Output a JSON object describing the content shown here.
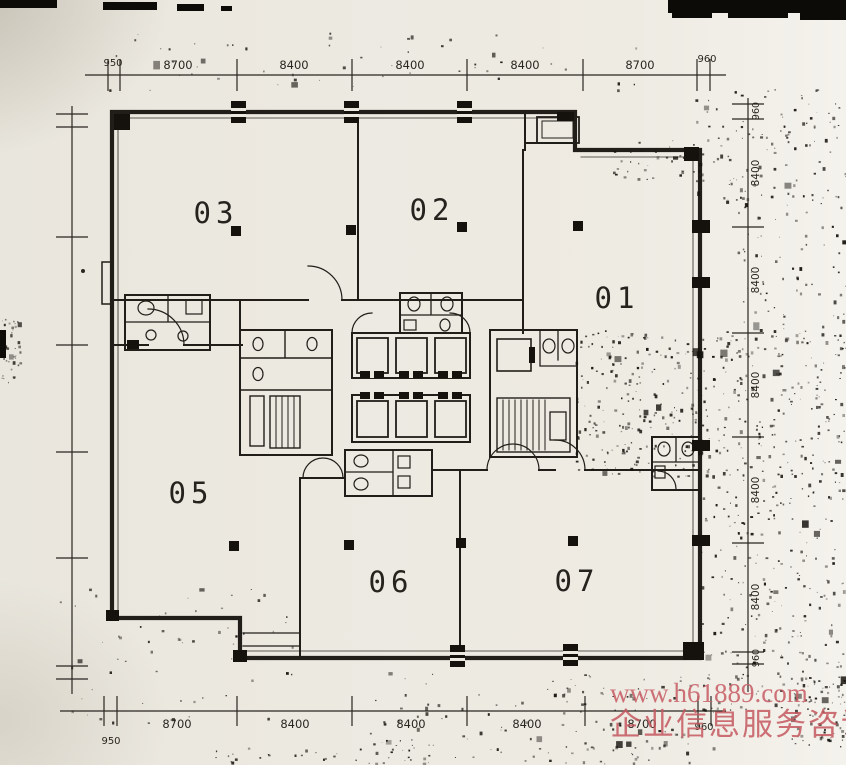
{
  "rooms": [
    {
      "label": "03"
    },
    {
      "label": "02"
    },
    {
      "label": "01"
    },
    {
      "label": "05"
    },
    {
      "label": "06"
    },
    {
      "label": "07"
    }
  ],
  "dimensions": {
    "top": {
      "left_small": "950",
      "segments": [
        "8700",
        "8400",
        "8400",
        "8400",
        "8700"
      ],
      "right_small": "960"
    },
    "bottom": {
      "left_small": "950",
      "segments": [
        "8700",
        "8400",
        "8400",
        "8400",
        "8700"
      ],
      "right_small": "960"
    },
    "right": {
      "top_small": "960",
      "segments": [
        "8400",
        "8400",
        "8400",
        "8400",
        "8400"
      ],
      "bottom_small": "960"
    }
  },
  "watermark": {
    "line1": "www.h61889.com",
    "line2": "企业信息服务咨询"
  },
  "colors": {
    "paper": "#ebe8e0",
    "ink": "#211e19",
    "watermark": "#c75f66"
  }
}
